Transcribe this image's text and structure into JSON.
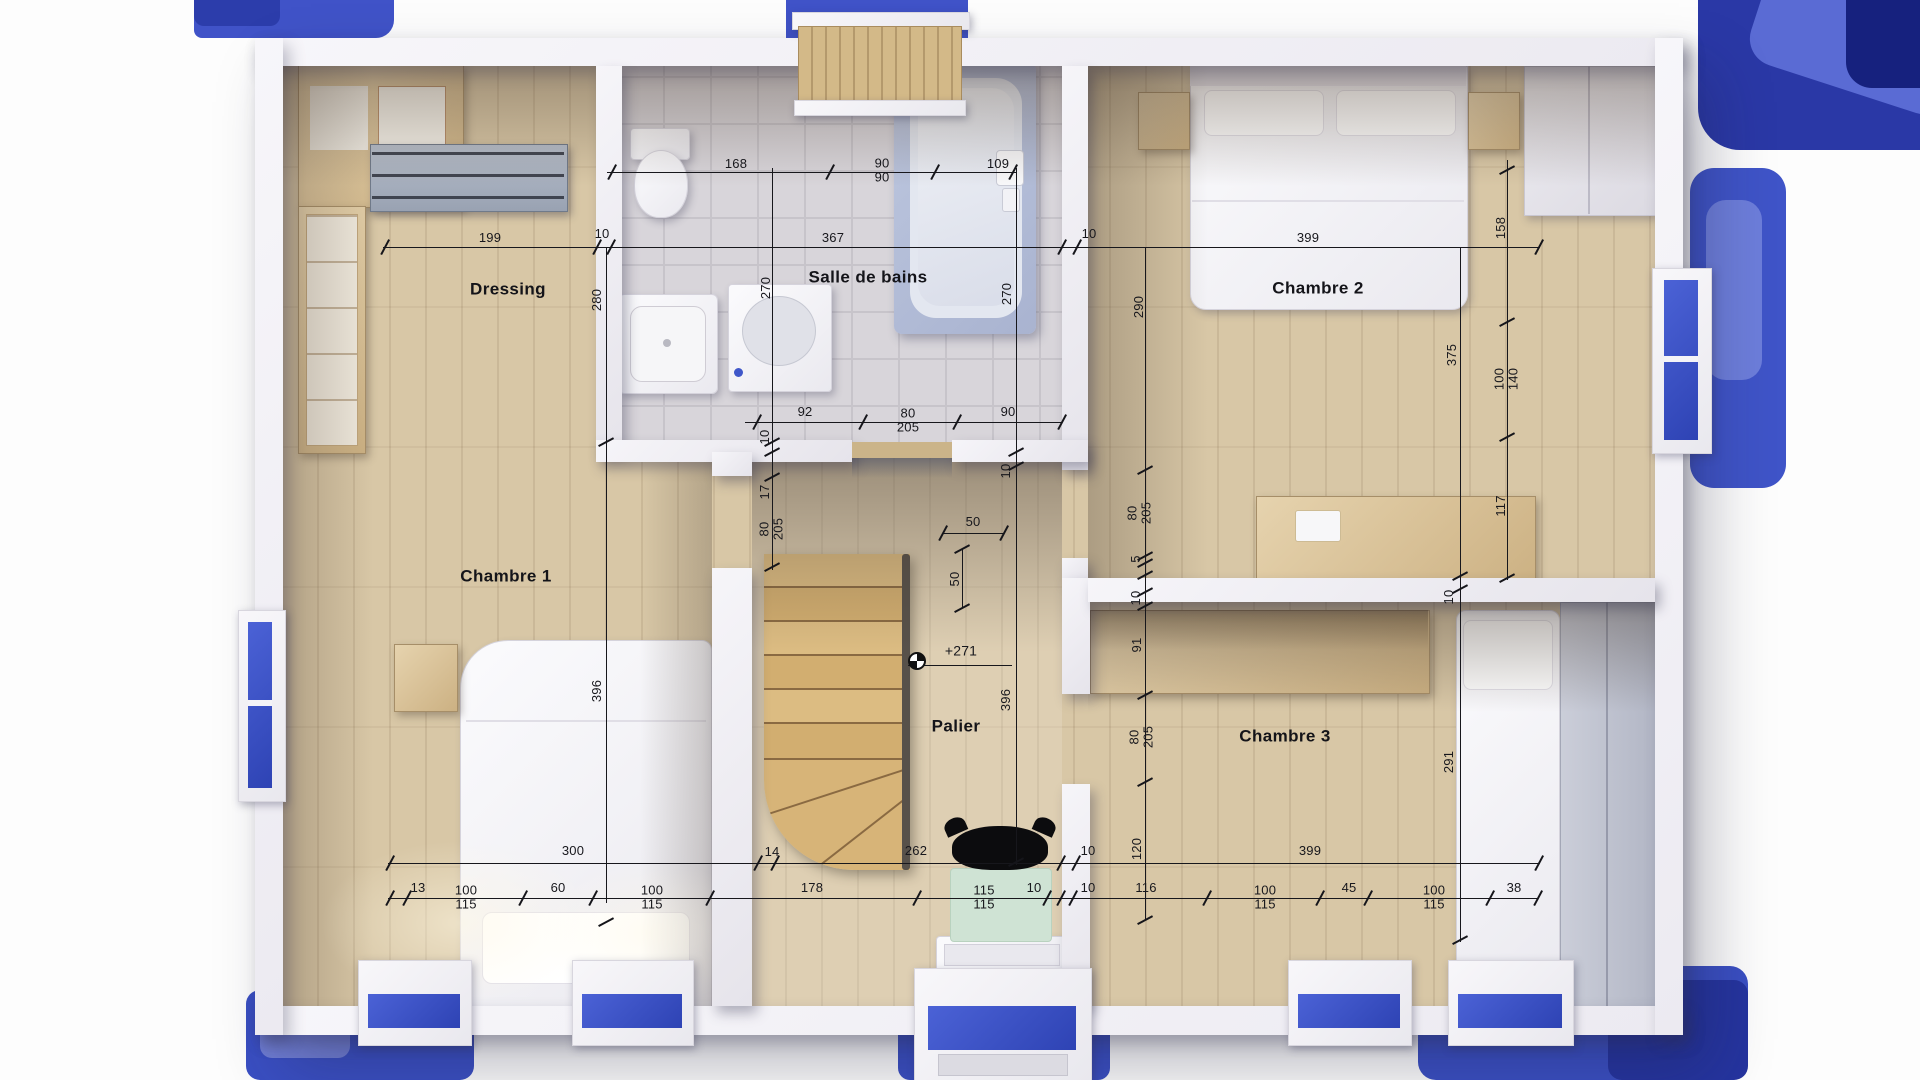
{
  "plan": {
    "type": "floor-plan-3d-render",
    "floor": "upper-floor",
    "colors": {
      "background_blue": "#3d53c8",
      "roof_navy": "#28379f",
      "wood_floor": "#d8c7a6",
      "tile_floor": "#d8d5da",
      "wall_white": "#f3f2f6",
      "dimension_ink": "#17171c",
      "stair_wood": "#d7b478",
      "mat_green": "#cfe3d4"
    },
    "icons": {
      "level_marker": "level-marker-icon",
      "lamp": "ceiling-lamp-icon"
    }
  },
  "rooms": {
    "dressing": {
      "label": "Dressing"
    },
    "bathroom": {
      "label": "Salle de bains"
    },
    "bedroom1": {
      "label": "Chambre 1"
    },
    "bedroom2": {
      "label": "Chambre 2"
    },
    "bedroom3": {
      "label": "Chambre 3"
    },
    "landing": {
      "label": "Palier"
    }
  },
  "level_marker": {
    "text": "+271"
  },
  "annotations": [
    {
      "id": "bath-top-168",
      "text": "168"
    },
    {
      "id": "bath-top-90-90",
      "text": "90\n90"
    },
    {
      "id": "bath-top-109",
      "text": "109"
    },
    {
      "id": "top-199",
      "text": "199"
    },
    {
      "id": "top-10-a",
      "text": "10"
    },
    {
      "id": "top-367",
      "text": "367"
    },
    {
      "id": "top-10-b",
      "text": "10"
    },
    {
      "id": "top-399",
      "text": "399"
    },
    {
      "id": "right-158",
      "text": "158"
    },
    {
      "id": "right-100-140",
      "text": "100\n140"
    },
    {
      "id": "right-117",
      "text": "117"
    },
    {
      "id": "right-375",
      "text": "375"
    },
    {
      "id": "v-280",
      "text": "280"
    },
    {
      "id": "v-270-a",
      "text": "270"
    },
    {
      "id": "v-270-b",
      "text": "270"
    },
    {
      "id": "v-290",
      "text": "290"
    },
    {
      "id": "mid-92",
      "text": "92"
    },
    {
      "id": "mid-80-205",
      "text": "80\n205"
    },
    {
      "id": "mid-90",
      "text": "90"
    },
    {
      "id": "v-10-c",
      "text": "10"
    },
    {
      "id": "v-17",
      "text": "17"
    },
    {
      "id": "door1-80-205",
      "text": "80\n205"
    },
    {
      "id": "v-10-d",
      "text": "10"
    },
    {
      "id": "palier-50-h",
      "text": "50"
    },
    {
      "id": "palier-50-v",
      "text": "50"
    },
    {
      "id": "level",
      "text": "+271"
    },
    {
      "id": "v-396-palier",
      "text": "396"
    },
    {
      "id": "label-palier",
      "text": "Palier"
    },
    {
      "id": "label-ch1",
      "text": "Chambre 1"
    },
    {
      "id": "v-396-ch1",
      "text": "396"
    },
    {
      "id": "label-dressing",
      "text": "Dressing"
    },
    {
      "id": "label-bath",
      "text": "Salle de bains"
    },
    {
      "id": "label-ch2",
      "text": "Chambre 2"
    },
    {
      "id": "door2-80-205",
      "text": "80\n205"
    },
    {
      "id": "v-5",
      "text": "5"
    },
    {
      "id": "v-10-e",
      "text": "10"
    },
    {
      "id": "v-91",
      "text": "91"
    },
    {
      "id": "door3-80-205",
      "text": "80\n205"
    },
    {
      "id": "label-ch3",
      "text": "Chambre 3"
    },
    {
      "id": "v-10-f",
      "text": "10"
    },
    {
      "id": "v-291",
      "text": "291"
    },
    {
      "id": "bot-300",
      "text": "300"
    },
    {
      "id": "bot-14",
      "text": "14"
    },
    {
      "id": "bot-262",
      "text": "262"
    },
    {
      "id": "bot-10-a",
      "text": "10"
    },
    {
      "id": "v-120",
      "text": "120"
    },
    {
      "id": "bot-399",
      "text": "399"
    },
    {
      "id": "bot-13",
      "text": "13"
    },
    {
      "id": "bot-100-115-a",
      "text": "100\n115"
    },
    {
      "id": "bot-60",
      "text": "60"
    },
    {
      "id": "bot-100-115-b",
      "text": "100\n115"
    },
    {
      "id": "bot-178",
      "text": "178"
    },
    {
      "id": "bot-115-115",
      "text": "115\n115"
    },
    {
      "id": "bot-10-b",
      "text": "10"
    },
    {
      "id": "bot-10-c",
      "text": "10"
    },
    {
      "id": "bot-116",
      "text": "116"
    },
    {
      "id": "bot-100-115-c",
      "text": "100\n115"
    },
    {
      "id": "bot-45",
      "text": "45"
    },
    {
      "id": "bot-100-115-d",
      "text": "100\n115"
    },
    {
      "id": "bot-38",
      "text": "38"
    }
  ]
}
